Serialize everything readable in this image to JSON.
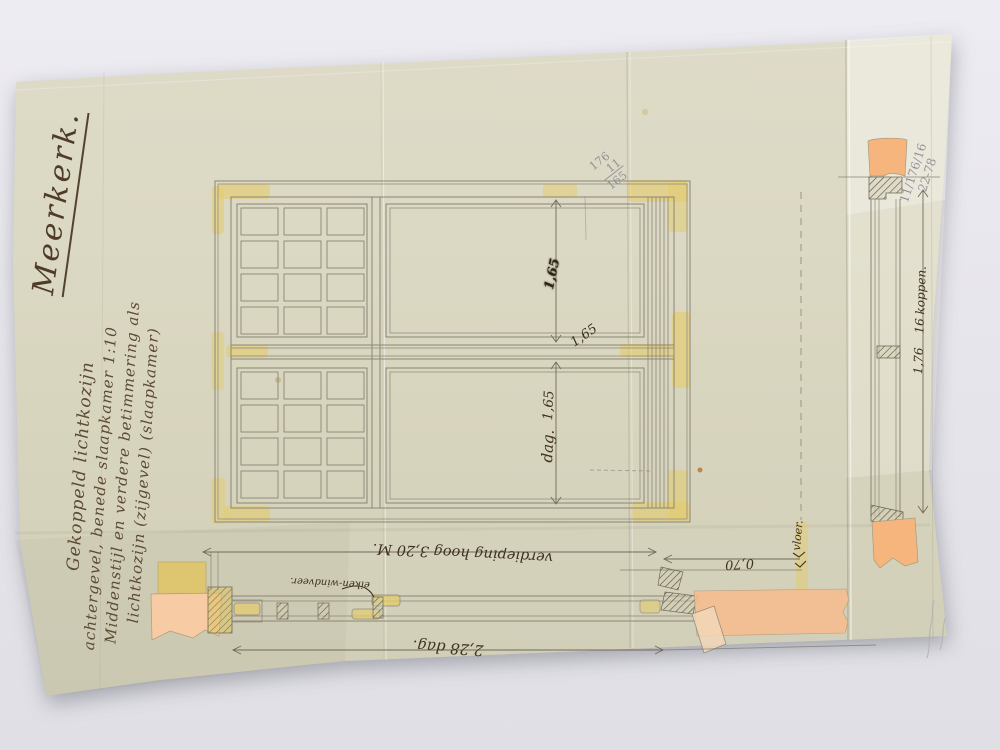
{
  "photo": {
    "backdrop_color": "#e7e6ec"
  },
  "paper": {
    "color": "#d8d5c0"
  },
  "handwriting": {
    "place_title": "Meerkerk.",
    "description_lines": [
      "Gekoppeld lichtkozijn",
      "achtergevel, benede slaapkamer 1:10",
      "Middenstijl en verdere betimmering als",
      "lichtkozijn (zijgevel) (slaapkamer)"
    ]
  },
  "pencil_notes": {
    "top_center_fraction": [
      "176",
      "11",
      "165"
    ],
    "top_right_lines": [
      "11/176/16",
      "22-78"
    ]
  },
  "measurements": {
    "upper_pane_height_smudged": "1,65",
    "upper_pane_height": "1,65",
    "lower_pane_height": "1,65",
    "lower_pane_day_label": "dag.",
    "section_height": "1,76",
    "section_brick_courses": "16 koppen.",
    "floor_label": "vloer.",
    "sill_height": "0,70",
    "storey_height": "verdieping hoog 3,20 M.",
    "opening_width": "2,28 dag.",
    "oak_part_label": "eiken-windveer."
  },
  "colors": {
    "wash_yellow": "#e4cc6b",
    "wash_orange": "#f5b57c",
    "wash_pink": "#f7cba4",
    "drawing_line": "#8b8677",
    "ink": "#3e311f",
    "pencil": "#94939b"
  }
}
